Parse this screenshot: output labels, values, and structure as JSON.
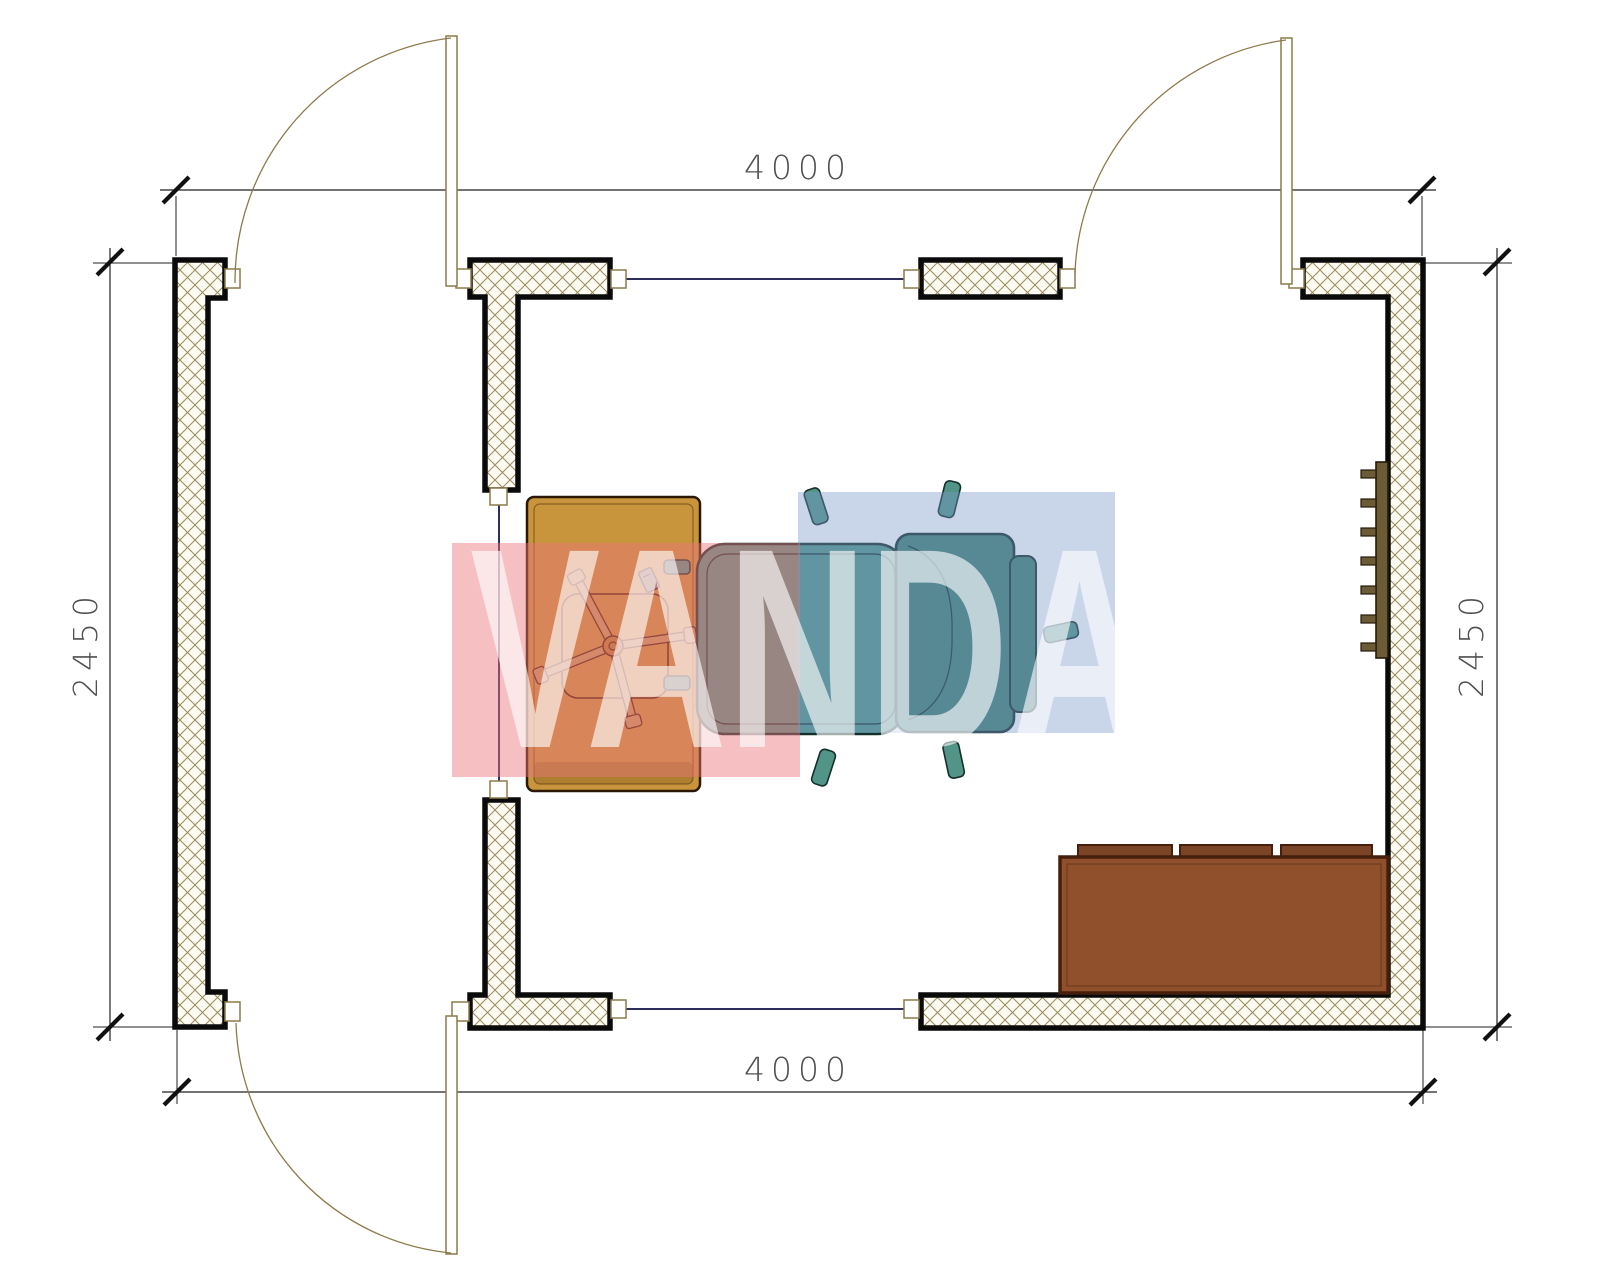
{
  "drawing": {
    "type": "floor-plan",
    "dimensions": {
      "top": "4000",
      "bottom": "4000",
      "left": "2450",
      "right": "2450"
    },
    "watermark": {
      "text": "VANDA",
      "pink_block": "#eb757c",
      "blue_block": "#7896c8",
      "text_color": "#ffffff"
    },
    "colors": {
      "wall_outline": "#0a0a0a",
      "hatch_line": "#9a8b5e",
      "hatch_bg": "#fdfbf2",
      "door": "#8c7b4a",
      "window": "#2e2e5e",
      "desk": "#c8943c",
      "chair_seat": "#529488",
      "chair_back": "#418174",
      "sofa": "#91502c",
      "sofa_cushion": "#7c4426",
      "radiator": "#6b5c36",
      "dimension": "#3c3c3c"
    },
    "furniture": {
      "desk": "desk",
      "office_chair": "office-chair-base",
      "armchair": "armchair",
      "sofa": "sofa",
      "radiator": "radiator"
    }
  }
}
